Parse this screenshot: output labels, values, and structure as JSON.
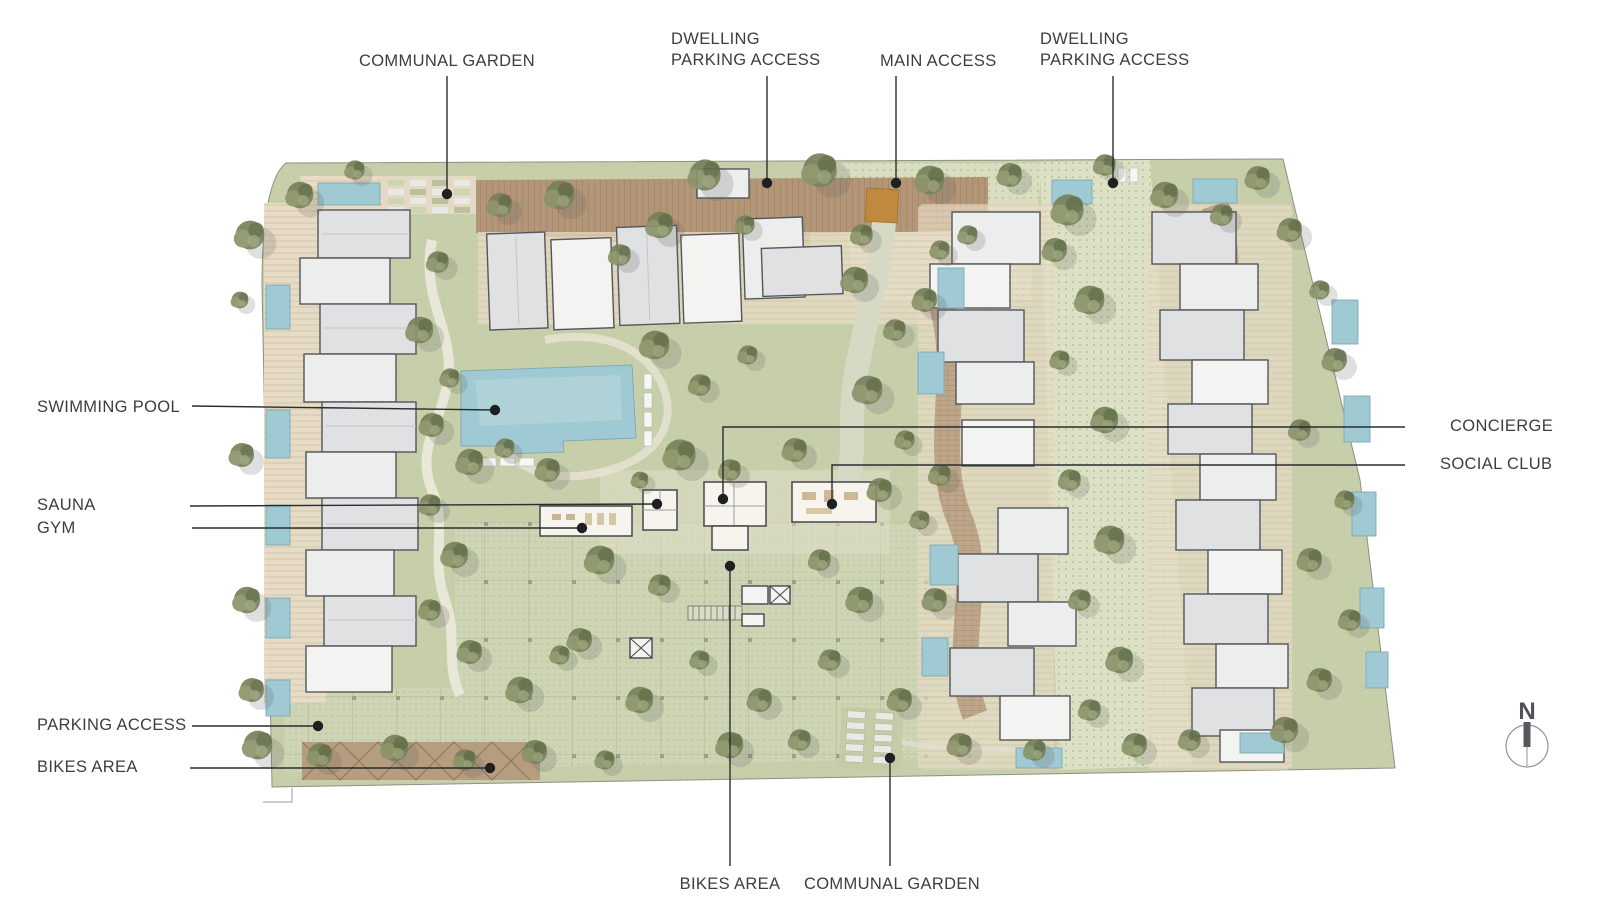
{
  "labels": {
    "communal_garden_top": "COMMUNAL GARDEN",
    "dwelling_parking_1": "DWELLING\nPARKING ACCESS",
    "main_access": "MAIN ACCESS",
    "dwelling_parking_2": "DWELLING\nPARKING ACCESS",
    "swimming_pool": "SWIMMING POOL",
    "sauna": "SAUNA",
    "gym": "GYM",
    "concierge": "CONCIERGE",
    "social_club": "SOCIAL CLUB",
    "parking_access": "PARKING ACCESS",
    "bikes_area_left": "BIKES AREA",
    "bikes_area_bottom": "BIKES AREA",
    "communal_garden_bottom": "COMMUNAL GARDEN"
  },
  "compass": {
    "north": "N"
  },
  "palette": {
    "background": "#ffffff",
    "lawn_green": "#c7cfaa",
    "paved_spine": "#dce1c5",
    "parking_deck": "#cdd5b4",
    "deck_wood_brown": "#b29677",
    "terrace_beige": "#e8dcc6",
    "building_gray": "#dfe1e2",
    "building_white": "#f3f3f1",
    "pool_blue": "#a7ccd5",
    "tree_olive": "#76815a",
    "main_access_orange": "#c08a3e",
    "annotation_ink": "#2b2d2e",
    "label_text": "#3b3e41"
  }
}
